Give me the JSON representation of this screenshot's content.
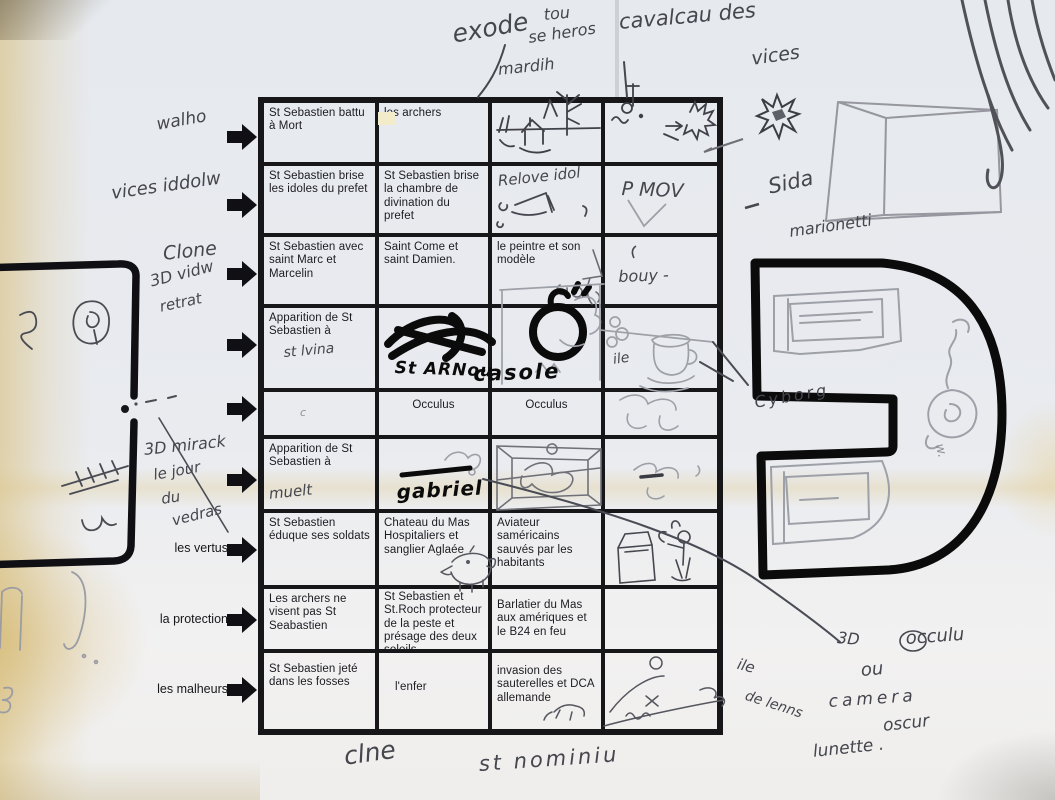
{
  "colors": {
    "paper": "#eaecef",
    "ink": "#17171a",
    "pen": "#46474f",
    "pencil": "#9ea0a8",
    "marker": "#0b0b0b",
    "stain": "#d9c48e"
  },
  "table": {
    "printed": {
      "r1c1": "St Sebastien battu à Mort",
      "r1c2": "les archers",
      "r2c1": "St Sebastien brise les idoles du prefet",
      "r2c2": "St Sebastien brise la chambre de divination du prefet",
      "r3c1": "St Sebastien avec saint Marc et Marcelin",
      "r3c2": "Saint Come et saint Damien.",
      "r3c3": "le peintre et son modèle",
      "r4c1": "Apparition de St Sebastien à",
      "r5c2": "Occulus",
      "r5c3": "Occulus",
      "r6c1": "Apparition de St Sebastien à",
      "r7c1": "St Sebastien éduque ses soldats",
      "r7c2": "Chateau du Mas Hospitaliers et sanglier Aglaée",
      "r7c3": "Aviateur saméricains sauvés par les habitants",
      "r8c1": "Les archers ne visent pas St Seabastien",
      "r8c2": "St Sebastien et St.Roch protecteur de la peste et présage des deux soleils",
      "r8c3": "Barlatier du Mas aux amériques et le B24 en feu",
      "r9c1": "St Sebastien jeté dans les fosses",
      "r9c2": "l'enfer",
      "r9c3": "invasion des sauterelles et DCA allemande"
    },
    "handwritten": {
      "r2c3": "Relove idol",
      "r2c4": "P MOV",
      "r3c4": "bouy -",
      "r4c1": "st lvina",
      "r4c2": "St ARNou",
      "r4c3": "casole",
      "r4c4": "ile",
      "r5c1": "c",
      "r6c1": "muelt",
      "r6c2": "gabriel"
    }
  },
  "row_labels": {
    "r1": "walho",
    "r2": "vices iddolw",
    "r3_1": "Clone",
    "r3_2": "3D vidw",
    "r3_3": "retrat",
    "r5_1": "3D mirack",
    "r5_2": "le jour",
    "r5_3": "du",
    "r5_4": "vedras",
    "r7": "les vertus",
    "r8": "la protection",
    "r9": "les malheurs"
  },
  "annotations": {
    "exode": "exode",
    "tou": "tou",
    "heros": "se heros",
    "mardih": "mardih",
    "cavalcade": "cavalcau des",
    "vices": "vices",
    "sida": "Sida",
    "marionette": "marionetti",
    "cyborg": "Cyborg",
    "w": "w.",
    "ile": "ile",
    "de_lenns": "de lenns",
    "d3": "3D",
    "occulu": "occulu",
    "ou": "ou",
    "camera": "camera",
    "oscur": "oscur",
    "lunette": "lunette .",
    "clne": "clne",
    "st_nominiu": "st nominiu"
  },
  "sketches": [
    "house-and-trees",
    "sun-bird-doodle",
    "idol-boat",
    "painter-figure",
    "marker-scribble",
    "marker-noose",
    "coffee-cup",
    "stage-room",
    "boar",
    "box-and-figure",
    "reclining-figure",
    "ear",
    "tally-marks",
    "star-burst",
    "perspective-box",
    "curtain-strokes",
    "screen-panels",
    "rose-scribble",
    "left-bracket-shape",
    "right-bracket-shape"
  ]
}
